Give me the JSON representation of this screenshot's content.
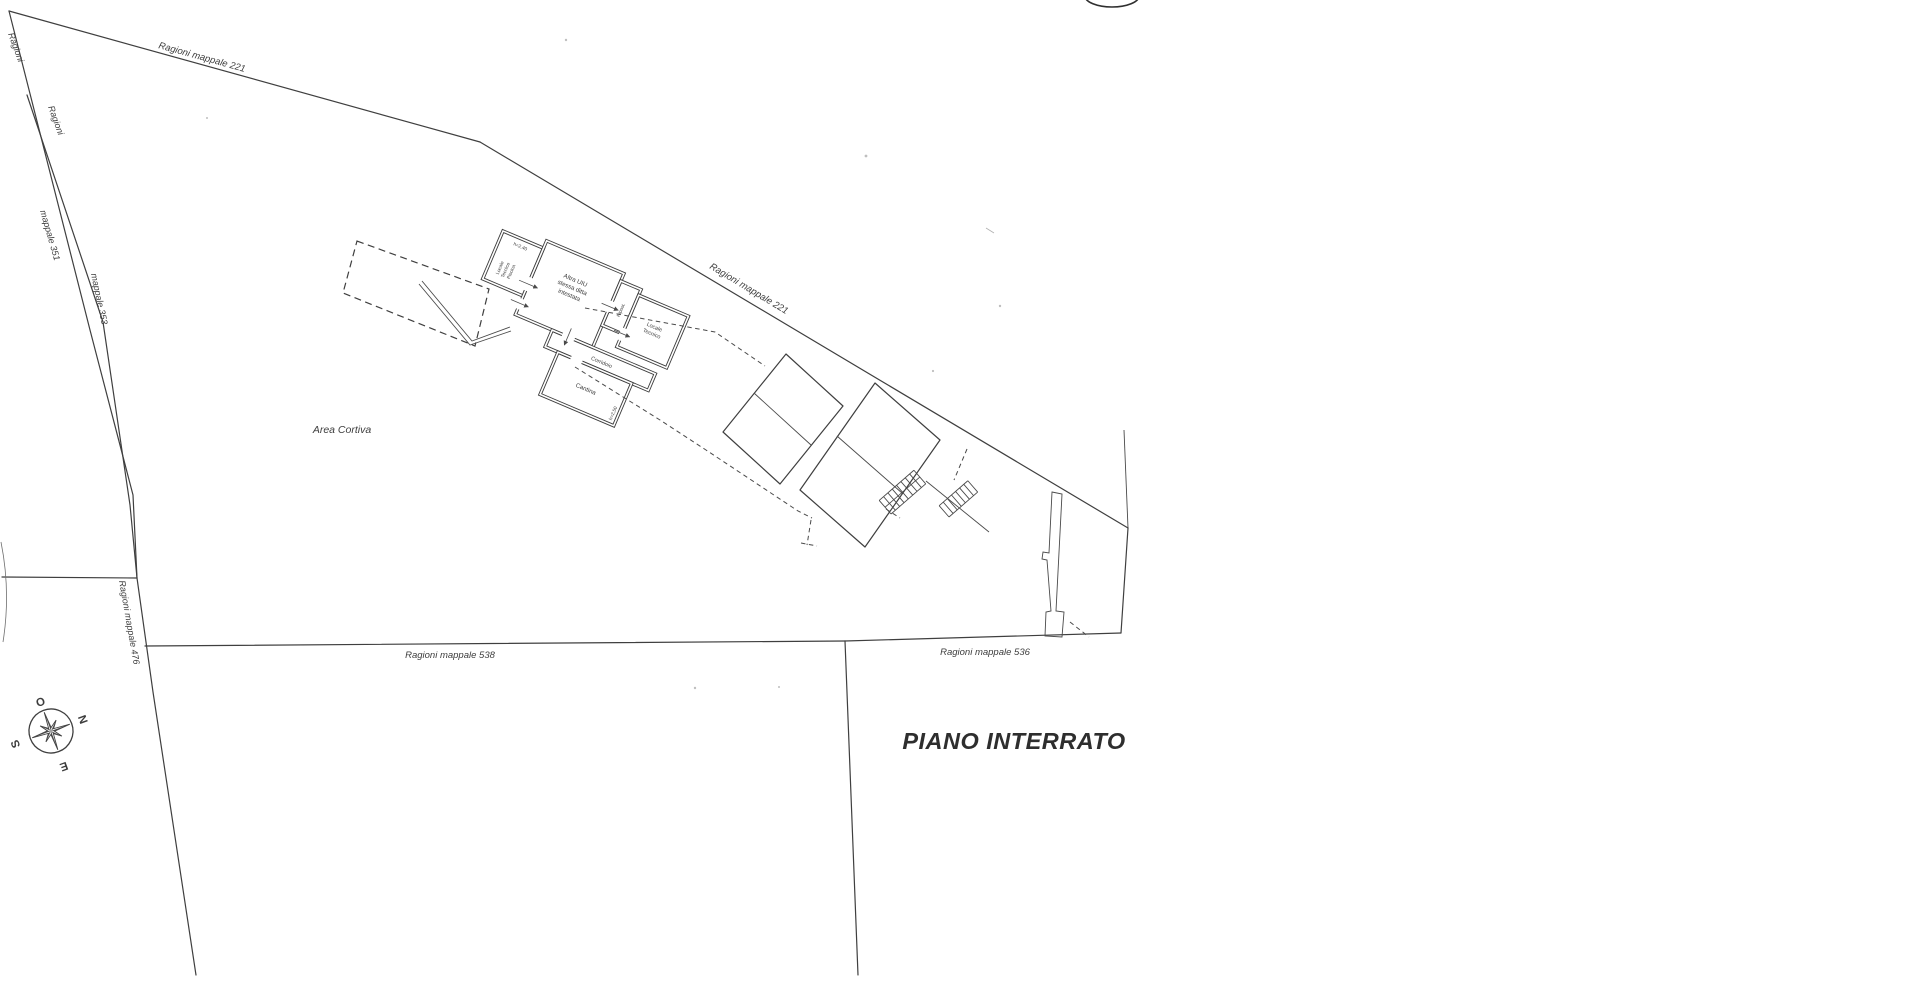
{
  "document": {
    "title": "PIANO INTERRATO"
  },
  "parcel_labels": {
    "ragioni_1": "Ragioni",
    "ragioni_2": "Ragioni",
    "mappale_351": "mappale 351",
    "mappale_353": "mappale 353",
    "mappale_476": "Ragioni mappale 476",
    "mappale_221_top": "Ragioni mappale 221",
    "mappale_221_mid": "Ragioni mappale 221",
    "mappale_538": "Ragioni mappale 538",
    "mappale_536": "Ragioni mappale 536",
    "area_cortiva": "Area Cortiva"
  },
  "rooms": {
    "piscina": {
      "height_note": "h=2,40",
      "lines": [
        "Locale",
        "Tecnico",
        "Piscina"
      ]
    },
    "altra_uiu": {
      "lines": [
        "Altra UIU",
        "stessa ditta",
        "intestata"
      ]
    },
    "ripostiglio": {
      "label": "Ripost."
    },
    "locale_tecnico": {
      "lines": [
        "Locale",
        "Tecnico"
      ]
    },
    "corridoio": {
      "label": "Corridoio"
    },
    "cantina": {
      "label": "Cantina",
      "height_note": "h=2,50"
    }
  },
  "compass": {
    "north": "N",
    "south": "S",
    "east": "E",
    "west": "O"
  },
  "colors": {
    "paper": "#ffffff",
    "ink": "#3f3f3f",
    "ink_light": "#6f6f6f"
  }
}
